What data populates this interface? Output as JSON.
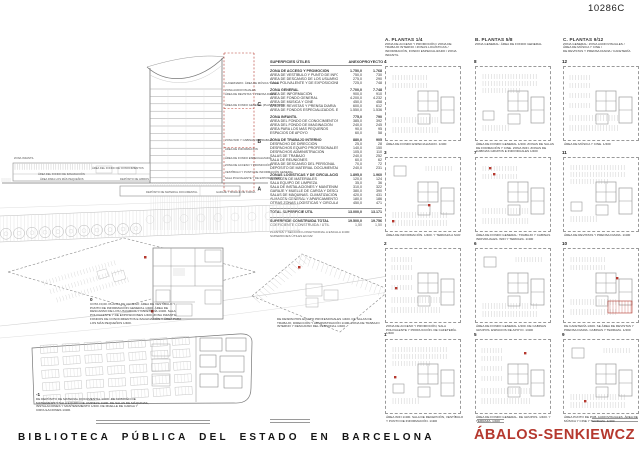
{
  "board": {
    "code": "10286C",
    "title": "BIBLIOTECA PÚBLICA DEL ESTADO EN BARCELONA",
    "architect": "ÁBALOS-SENKIEWCZ"
  },
  "colors": {
    "accent": "#b5382e",
    "drawing_line": "#8a8a8a"
  },
  "section": {
    "zones": [
      "C",
      "B",
      "A"
    ],
    "labels": [
      {
        "text": "LUCERNARIO. ÁREA DE MÚSICA Y CINE",
        "x": 225,
        "y": 56
      },
      {
        "text": "ZONA AUDIOVISUALES",
        "x": 225,
        "y": 63
      },
      {
        "text": "ÁREA DE REVISTAS Y PRENSA DIARIA",
        "x": 225,
        "y": 67
      },
      {
        "text": "ÁREA DE FONDO GENERAL (PLANTAS TIPO)",
        "x": 225,
        "y": 78
      },
      {
        "text": "ZONA WIFI Y CABINAS DE TRABAJO",
        "x": 225,
        "y": 113
      },
      {
        "text": "ÁREA DE INFORMACIÓN",
        "x": 225,
        "y": 122
      },
      {
        "text": "ÁREA DE FONDO ESPECIALIZADO",
        "x": 225,
        "y": 131
      },
      {
        "text": "ZONA DE ACCESO Y PROMOCIÓN",
        "x": 225,
        "y": 138
      },
      {
        "text": "VESTÍBULO Y PUNTO DE INFORMACIÓN GENERAL",
        "x": 225,
        "y": 145
      },
      {
        "text": "SALA POLIVALENTE Y DE EXPOSICIONES",
        "x": 225,
        "y": 151
      }
    ],
    "wing_labels": [
      {
        "text": "ZONA INFANTIL",
        "x": 14,
        "y": 131
      },
      {
        "text": "ÁREA DEL FONDO DE CONOCIMIENTOS",
        "x": 92,
        "y": 141
      },
      {
        "text": "ÁREA DEL FONDO DE IMAGINACIÓN",
        "x": 38,
        "y": 147
      },
      {
        "text": "ÁREA PARA LOS MÁS PEQUEÑOS",
        "x": 40,
        "y": 152
      },
      {
        "text": "DEPÓSITO DE LIBROS",
        "x": 120,
        "y": 152
      },
      {
        "text": "DEPÓSITO DE MATERIAL DOCUMENTAL",
        "x": 146,
        "y": 165
      },
      {
        "text": "GARAJE Y MUELLE DE CARGA",
        "x": 216,
        "y": 165
      }
    ]
  },
  "areas_table": {
    "title": "SUPERFICIES ÚTILES",
    "col1": "ANEXO",
    "col2": "PROYECTO",
    "rows": [
      {
        "label": "ZONA DE ACCESO Y PROMOCIÓN",
        "a": "1.750,0",
        "p": "1.768",
        "bold": true
      },
      {
        "label": "ÁREA DE VESTÍBULO Y PUNTO DE INFORMACIÓN GENERAL",
        "a": "750,0",
        "p": "730"
      },
      {
        "label": "ÁREA DE DESCANSO DE LOS USUARIOS. CAFETERÍA",
        "a": "275,0",
        "p": "290"
      },
      {
        "label": "SALA POLIVALENTE Y DE EXPOSICIONES",
        "a": "725,0",
        "p": "748"
      },
      {
        "label": "ZONA GENERAL",
        "a": "7.700,0",
        "p": "7.748",
        "bold": true
      },
      {
        "label": "ÁREA DE INFORMACIÓN",
        "a": "900,0",
        "p": "910"
      },
      {
        "label": "ÁREA DE FONDO GENERAL",
        "a": "4.200,0",
        "p": "4.232"
      },
      {
        "label": "ÁREA DE MÚSICA Y CINE",
        "a": "450,0",
        "p": "458"
      },
      {
        "label": "ÁREA DE REVISTAS Y PRENSA DIARIA",
        "a": "600,0",
        "p": "612"
      },
      {
        "label": "ÁREA DE FONDOS ESPECIALIZADOS. ESPACIOS DE APOYO",
        "a": "1.550,0",
        "p": "1.536"
      },
      {
        "label": "ZONA INFANTIL",
        "a": "775,0",
        "p": "790",
        "bold": true
      },
      {
        "label": "ÁREA DEL FONDO DE CONOCIMIENTOS",
        "a": "385,0",
        "p": "392"
      },
      {
        "label": "ÁREA DEL FONDO DE IMAGINACIÓN",
        "a": "240,0",
        "p": "245"
      },
      {
        "label": "ÁREA PARA LOS MÁS PEQUEÑOS",
        "a": "90,0",
        "p": "95"
      },
      {
        "label": "ESPACIOS DE APOYO",
        "a": "60,0",
        "p": "58"
      },
      {
        "label": "ZONA DE TRABAJO INTERNO",
        "a": "880,0",
        "p": "905",
        "bold": true
      },
      {
        "label": "DESPACHO DE DIRECCIÓN",
        "a": "25,0",
        "p": "28"
      },
      {
        "label": "DESPACHOS EQUIPO PROFESIONALES",
        "a": "140,0",
        "p": "150"
      },
      {
        "label": "DESPACHOS ADMINISTRACIÓN",
        "a": "105,0",
        "p": "110"
      },
      {
        "label": "SALAS DE TRABAJO",
        "a": "240,0",
        "p": "252"
      },
      {
        "label": "SALA DE REUNIONES",
        "a": "60,0",
        "p": "62"
      },
      {
        "label": "ÁREA DE DESCANSO DEL PERSONAL",
        "a": "70,0",
        "p": "72"
      },
      {
        "label": "DEPÓSITO DE MATERIAL DOCUMENTAL",
        "a": "240,0",
        "p": "231"
      },
      {
        "label": "ZONAS LOGÍSTICAS Y DE CIRCULACIÓN",
        "a": "1.895,0",
        "p": "1.960",
        "bold": true
      },
      {
        "label": "ALMACÉN DE MATERIALES",
        "a": "120,0",
        "p": "124"
      },
      {
        "label": "SALA EQUIPO DE LIMPIEZA",
        "a": "35,0",
        "p": "36"
      },
      {
        "label": "SALA DE INSTALACIONES Y MANTENIMIENTO",
        "a": "310,0",
        "p": "322"
      },
      {
        "label": "GARAJE Y MUELLE DE CARGA Y DESCARGA",
        "a": "380,0",
        "p": "390"
      },
      {
        "label": "SALAS DE MÁQUINAS. CLIMATIZACIÓN Y VENTILACIÓN",
        "a": "420,0",
        "p": "431"
      },
      {
        "label": "ALMACÉN GENERAL Y APARCAMIENTO",
        "a": "180,0",
        "p": "186"
      },
      {
        "label": "OTRAS ZONAS LOGÍSTICAS Y CIRCULACIONES",
        "a": "450,0",
        "p": "471"
      },
      {
        "label": "TOTAL SUPERFICIE ÚTIL",
        "a": "13.000,0",
        "p": "13.171",
        "total": true
      },
      {
        "label": "SUPERFICIE CONSTRUIDA TOTAL",
        "a": "19.500,0",
        "p": "19.756",
        "total": true
      },
      {
        "label": "COEFICIENTE CONSTRUIDA / ÚTIL",
        "a": "1,50",
        "p": "1,50",
        "small": true
      }
    ],
    "notes": [
      "PLANTAS Y SECCIÓN LONGITUDINAL A ESCALA 1/400",
      "SUPERFICIES ÚTILES EN M2"
    ]
  },
  "plan_columns": [
    {
      "title": "A. PLANTAS 1/4",
      "desc": "ZONA DE ACCESO Y PROMOCIÓN / ZONA DE\nTRABAJO INTERNO / ZONAS LOGÍSTICAS /\nINFORMACIÓN, FONDO ESPECIALIZADO / ZONA\nINFANTIL"
    },
    {
      "title": "B. PLANTAS 5/8",
      "desc": "ZONA GENERAL: ÁREA DE FONDO GENERAL"
    },
    {
      "title": "C. PLANTAS 9/12",
      "desc": "ZONA GENERAL: ZONA AUDIOVISUALES /\nÁREA DE MÚSICA Y CINE /\nDE REVISTAS Y PRENSA DIARIA / CAFETERÍA"
    }
  ],
  "floor_plans": [
    {
      "number": "4",
      "caption": "ÁREA DE FONDO ESPECIALIZADO. 1/400",
      "marks": []
    },
    {
      "number": "8",
      "caption": "ÁREA DE FONDO GENERAL 1/400. ZONAS DE SALAS DE FORMACIÓN Y CINE. ZONA WIFI. ZONAS DE CABINAS GRUPOS E INDIVIDUALES 1/400",
      "marks": []
    },
    {
      "number": "12",
      "caption": "ÁREA DE MÚSICA Y CINE. 1/400",
      "marks": []
    },
    {
      "number": "3",
      "caption": "ÁREA DE INFORMACIÓN. 1/400. Y TERRAZA A SUR",
      "marks": [
        [
          6,
          62
        ],
        [
          42,
          46
        ]
      ]
    },
    {
      "number": "7",
      "caption": "ÁREA DE FONDO GENERAL: TRABAJO Y CABINAS INDIVIDUALES. WIFI Y TERRAZA. 1/400",
      "marks": [
        [
          13,
          9
        ],
        [
          17,
          15
        ]
      ]
    },
    {
      "number": "11",
      "caption": "ÁREA DE REVISTAS Y PRENSA DIARIA. 1/400",
      "marks": []
    },
    {
      "number": "2",
      "caption": "ZONA DE ACCESO Y PROMOCIÓN, SALA POLIVALENTE Y PRODUCCIÓN. DE CAFETERÍA. 1/400",
      "marks": [
        [
          9,
          38
        ]
      ]
    },
    {
      "number": "6",
      "caption": "ÁREA DE FONDO GENERAL 1/400. DE CABINAS GRUPOS. ESPACIOS DE APOYO. 1/400",
      "marks": []
    },
    {
      "number": "10",
      "caption": "DE CAFETERÍA 1/400. SE ÁREA DE REVISTAS Y PRENSA DIARIA. CABINAS Y TERRAZA. 1/400",
      "marks": [
        [
          52,
          28
        ]
      ],
      "red_area": [
        44,
        52,
        24,
        12
      ]
    },
    {
      "number": "1",
      "caption": "ÁREA WIFI 1/400. SALA DE RECEPCIÓN, VESTÍBULO Y PUNTO DE INFORMACIÓN. 1/400",
      "marks": [
        [
          8,
          36
        ]
      ]
    },
    {
      "number": "5",
      "caption": "ÁREA DE FONDO GENERAL. DE GRUPOS. 1/400. Y TERRAZA. 1/400",
      "marks": [
        [
          48,
          12
        ]
      ]
    },
    {
      "number": "9",
      "caption": "ÁREA PUNTO DE PUB. AUDIOVISUALES. ÁREA DE MÚSICA Y CINE Y TERRAZA. 1/400",
      "marks": [
        [
          20,
          60
        ]
      ]
    }
  ],
  "site_plans": {
    "ground": {
      "number": "0",
      "caption": "COTA ±0,00. PLANTA DE ACCESO: ÁREA DE VESTÍBULO Y PUNTO DE INFORMACIÓN GENERAL 1/400. ÁREA DE DESCANSO DE LOS USUARIOS Y CAFETERÍA 1/400. SALA POLIVALENTE Y DE EXPOSICIONES 1/400. ZONA INFANTIL: FONDOS DE CONOCIMIENTOS E IMAGINACIÓN Y ÁREA PARA LOS MÁS PEQUEÑOS 1/400."
    },
    "internal": {
      "caption": "DE DESPACHOS EQUIPO PROFESIONALES 1/400. DE SALAS DE TRABAJO, DIRECCIÓN Y ADMINISTRACIÓN 1/400. ZONA DE TRABAJO INTERNO Y DESCANSO DEL PERSONAL 1/400."
    },
    "basement": {
      "number": "-1",
      "caption": "DE DEPÓSITO DE MATERIAL DOCUMENTAL 1/400. DE ALMACÉN DE MATERIALES Y SALA EQUIPO DE LIMPIEZA 1/400. DE SALAS DE MÁQUINAS, INSTALACIONES Y MANTENIMIENTO 1/400. DE MUELLE DE CARGA Y CIRCULACIONES 1/400."
    }
  }
}
